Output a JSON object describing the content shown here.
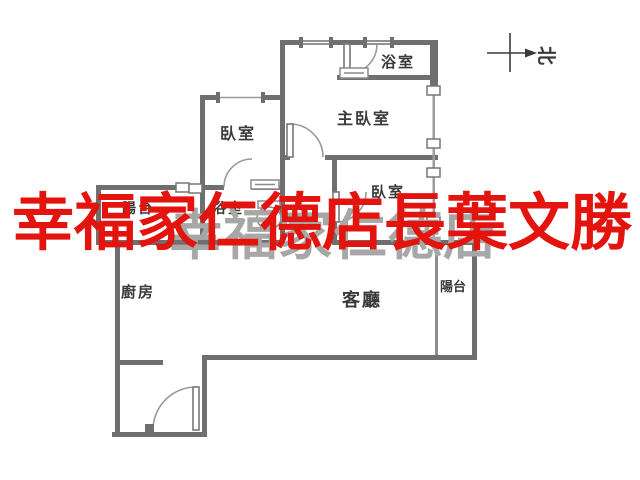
{
  "canvas": {
    "background": "#ffffff",
    "wall_color": "#6f6f6f",
    "thin_wall_color": "#8d8d8d",
    "label_color": "#3a3a3a"
  },
  "watermark": {
    "primary_text": "幸福家仁德店長葉文勝",
    "primary_color": "#e3130e",
    "secondary_text": "幸福家仁德店",
    "secondary_color": "#a7a7a7"
  },
  "compass": {
    "north_label": "北"
  },
  "rooms": {
    "bathroom_top": "浴室",
    "master_bedroom": "主臥室",
    "bedroom_left": "臥室",
    "bedroom_right": "臥室",
    "balcony_left": "陽台",
    "bathroom_mid": "浴室",
    "kitchen": "廚房",
    "living_room": "客廳",
    "balcony_right": "陽台"
  }
}
